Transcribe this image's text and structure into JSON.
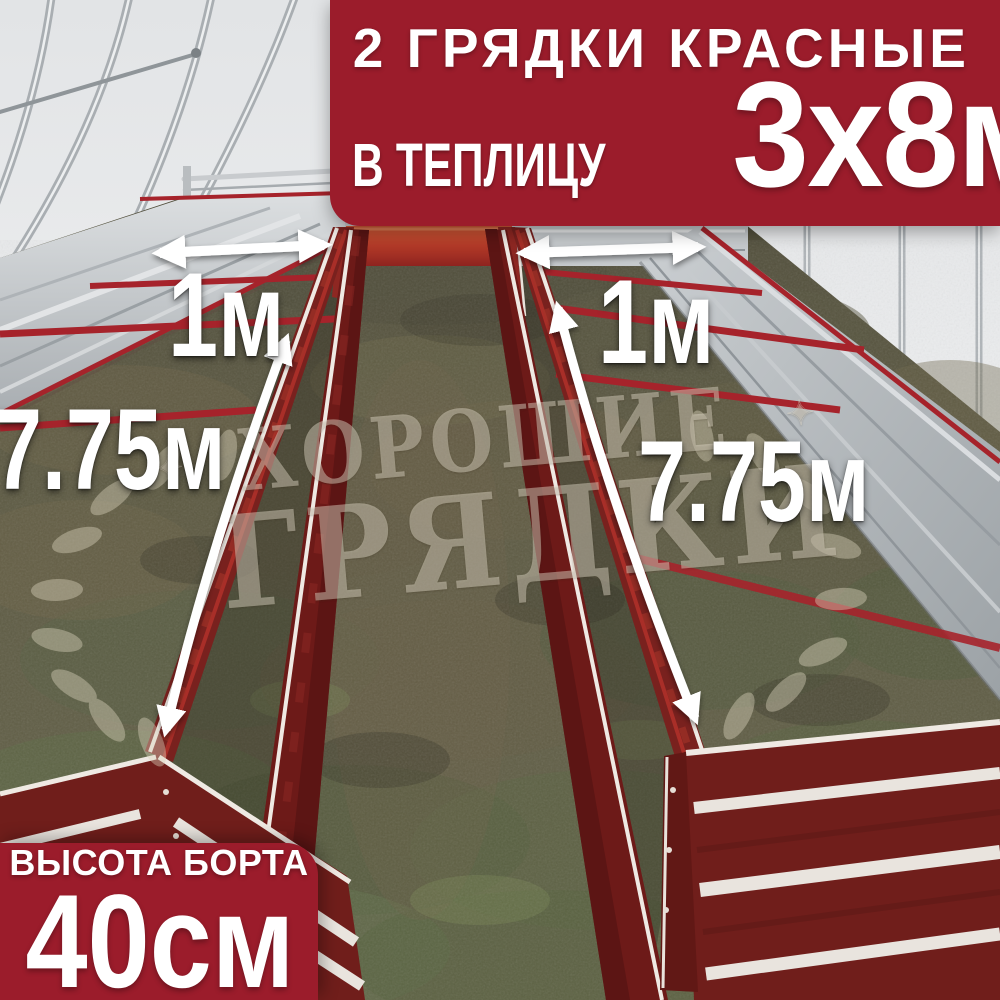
{
  "top_banner": {
    "line1": "2 ГРЯДКИ КРАСНЫЕ",
    "line2_prefix": "В ТЕПЛИЦУ",
    "line2_value": "3х8м",
    "bg_color": "#9B1C2B",
    "text_color": "#FFFFFF"
  },
  "bottom_banner": {
    "line1": "ВЫСОТА БОРТА",
    "line2": "40см",
    "bg_color": "#9B1C2B",
    "text_color": "#FFFFFF"
  },
  "labels": {
    "left_bed_width": "1м",
    "right_bed_width": "1м",
    "left_bed_length": "7.75м",
    "right_bed_length": "7.75м"
  },
  "watermark": {
    "star": "✦",
    "line1": "ХОРОШИЕ",
    "line2": "ГРЯДКИ"
  },
  "photo": {
    "colors": {
      "bed_red": "#76201D",
      "accent_red": "#A6232B",
      "galvanized": "#C3C7CA",
      "wall": "#E8EAEC",
      "ground": "#625E46"
    }
  }
}
